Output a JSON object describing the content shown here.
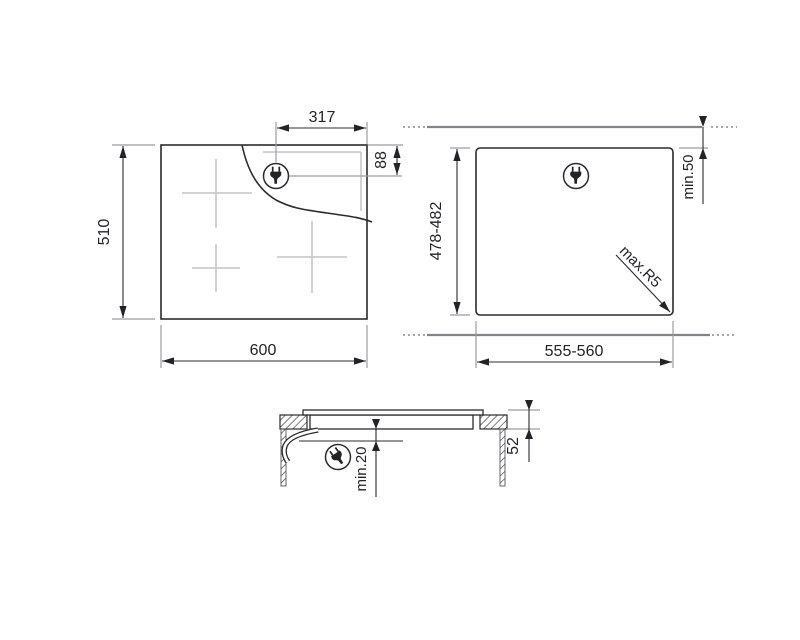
{
  "diagram": {
    "title": "hob-installation-drawing",
    "top_view": {
      "width": "600",
      "depth": "510",
      "plug_offset_from_right": "317",
      "plug_offset_from_top": "88"
    },
    "cutout_view": {
      "width": "555-560",
      "depth": "478-482",
      "rear_clearance": "min.50",
      "corner_radius": "max.R5"
    },
    "section_view": {
      "built_in_height": "52",
      "bottom_clearance": "min.20"
    },
    "icons": {
      "plug": "power-plug-icon"
    },
    "colors": {
      "line_black": "#2b2b2e",
      "line_gray": "#9b9c9e",
      "line_light_gray": "#c2c3c5",
      "worktop_gray": "#838487",
      "background": "#ffffff"
    }
  }
}
